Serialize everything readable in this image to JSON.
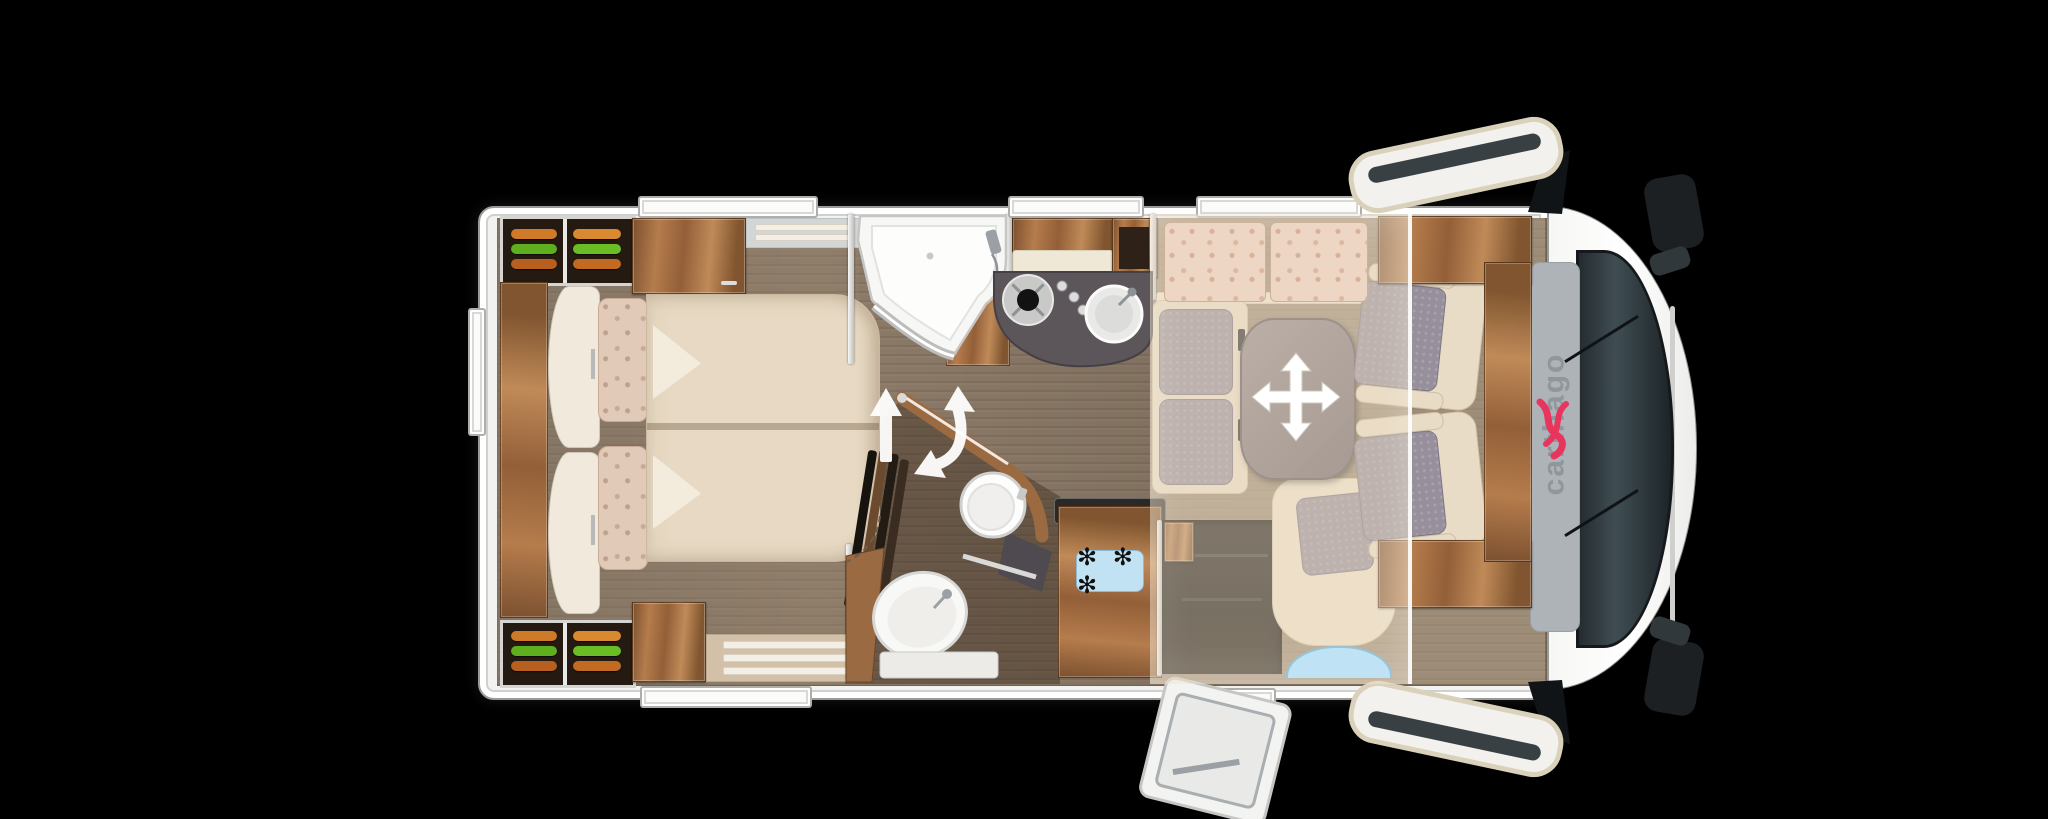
{
  "scene": {
    "kind": "motorhome floor plan, top view",
    "background": "#000000"
  },
  "branding": {
    "cab_logo": "carthago"
  },
  "fridge": {
    "freezer_label": "✻ ✻ ✻"
  },
  "icons": {
    "table_adjust": "four-way-move-arrows",
    "partition_swing": "curved-double-arrow",
    "bed_slide": "straight-up-arrow",
    "freezer_rating": "three-snowflakes",
    "brand_emblem": "red-carthago-emblem"
  },
  "palette": {
    "shell": "#f2f2f0",
    "wood": "#a9744a",
    "worktop": "#5c5559",
    "floor": "#8d7b68",
    "upholstery": "#e9dcc6",
    "seat_fabric": "#97909c",
    "logo_red": "#e8355e",
    "entry_step_blue": "#bfe3f5"
  }
}
